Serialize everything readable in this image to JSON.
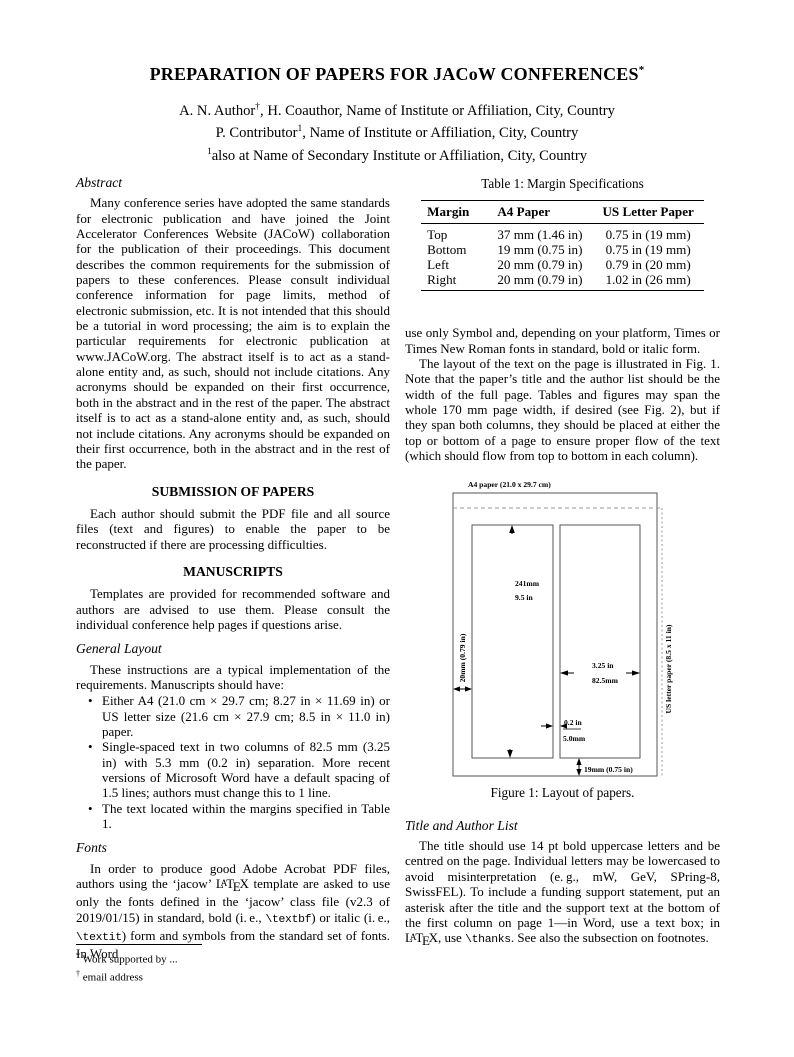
{
  "header": {
    "title": "PREPARATION OF PAPERS FOR JACoW CONFERENCES",
    "title_mark": "*",
    "authors": [
      {
        "pre": "A. N. Author",
        "sup": "†",
        "post": ", H. Coauthor, Name of Institute or Affiliation, City, Country"
      },
      {
        "pre": "P. Contributor",
        "sup": "1",
        "post": ", Name of Institute or Affiliation, City, Country"
      },
      {
        "pre": "",
        "sup": "1",
        "post": "also at Name of Secondary Institute or Affiliation, City, Country"
      }
    ]
  },
  "left": {
    "abstract_heading": "Abstract",
    "abstract_text": "Many conference series have adopted the same standards for electronic publication and have joined the Joint Accelerator Conferences Website (JACoW) collaboration for the publication of their proceedings. This document describes the common requirements for the submission of papers to these conferences. Please consult individual conference information for page limits, method of electronic submission, etc. It is not intended that this should be a tutorial in word processing; the aim is to explain the particular requirements for electronic publication at www.JACoW.org. The abstract itself is to act as a stand-alone entity and, as such, should not include citations. Any acronyms should be expanded on their first occurrence, both in the abstract and in the rest of the paper. The abstract itself is to act as a stand-alone entity and, as such, should not include citations. Any acronyms should be expanded on their first occurrence, both in the abstract and in the rest of the paper.",
    "submission_heading": "SUBMISSION OF PAPERS",
    "submission_text": "Each author should submit the PDF file and all source files (text and figures) to enable the paper to be reconstructed if there are processing difficulties.",
    "manuscripts_heading": "MANUSCRIPTS",
    "manuscripts_text": "Templates are provided for recommended software and authors are advised to use them. Please consult the individual conference help pages if questions arise.",
    "general_layout_heading": "General Layout",
    "general_layout_intro": "These instructions are a typical implementation of the requirements. Manuscripts should have:",
    "bullet_glyph": "•",
    "bullets": [
      "Either A4 (21.0 cm × 29.7 cm; 8.27 in × 11.69 in) or US letter size (21.6 cm × 27.9 cm; 8.5 in × 11.0 in) paper.",
      "Single-spaced text in two columns of 82.5 mm (3.25 in) with 5.3 mm (0.2 in) separation. More recent versions of Microsoft Word have a default spacing of 1.5 lines; authors must change this to 1 line.",
      "The text located within the margins specified in Table 1."
    ],
    "fonts_heading": "Fonts",
    "fonts_seg1": "In order to produce good Adobe Acrobat PDF files, authors using the ‘jacow’ ",
    "fonts_seg2": " template are asked to use only the fonts defined in the ‘jacow’ class file (v2.3 of 2019/01/15) in standard, bold (i. e., ",
    "fonts_mono1": "\\textbf",
    "fonts_seg3": ") or italic (i. e., ",
    "fonts_mono2": "\\textit",
    "fonts_seg4": ") form and symbols from the standard set of fonts. In Word",
    "footnotes": [
      {
        "sup": "*",
        "text": " Work supported by ..."
      },
      {
        "sup": "†",
        "text": " email address"
      }
    ]
  },
  "right": {
    "table_caption": "Table 1: Margin Specifications",
    "table": {
      "headers": [
        "Margin",
        "A4 Paper",
        "US Letter Paper"
      ],
      "rows": [
        [
          "Top",
          "37 mm (1.46 in)",
          "0.75 in (19 mm)"
        ],
        [
          "Bottom",
          "19 mm (0.75 in)",
          "0.75 in (19 mm)"
        ],
        [
          "Left",
          "20 mm (0.79 in)",
          "0.79 in (20 mm)"
        ],
        [
          "Right",
          "20 mm (0.79 in)",
          "1.02 in (26 mm)"
        ]
      ]
    },
    "para1": "use only Symbol and, depending on your platform, Times or Times New Roman fonts in standard, bold or italic form.",
    "para2": "The layout of the text on the page is illustrated in Fig. 1. Note that the paper’s title and the author list should be the width of the full page. Tables and figures may span the whole 170 mm page width, if desired (see Fig. 2), but if they span both columns, they should be placed at either the top or bottom of a page to ensure proper flow of the text (which should flow from top to bottom in each column).",
    "figure": {
      "label_a4": "A4 paper (21.0 x 29.7 cm)",
      "label_us": "US letter paper (8.5 x 11 in)",
      "label_height_mm": "241mm",
      "label_height_in": "9.5 in",
      "label_left_margin": "20mm (0.79 in)",
      "label_col_in": "3.25 in",
      "label_col_mm": "82.5mm",
      "label_gap_in": "0.2 in",
      "label_gap_mm": "5.0mm",
      "label_bottom": "19mm (0.75 in)",
      "caption": "Figure 1: Layout of papers."
    },
    "title_author_heading": "Title and Author List",
    "ta_seg1": "The title should use 14 pt bold uppercase letters and be centred on the page. Individual letters may be lowercased to avoid misinterpretation (e. g., mW, GeV, SPring-8, SwissFEL). To include a funding support statement, put an asterisk after the title and the support text at the bottom of the first column on page 1—in Word, use a text box; in ",
    "ta_seg2": ", use ",
    "ta_mono": "\\thanks",
    "ta_seg3": ". See also the subsection on footnotes."
  },
  "logo_latex": [
    "L",
    "A",
    "T",
    "E",
    "X"
  ]
}
